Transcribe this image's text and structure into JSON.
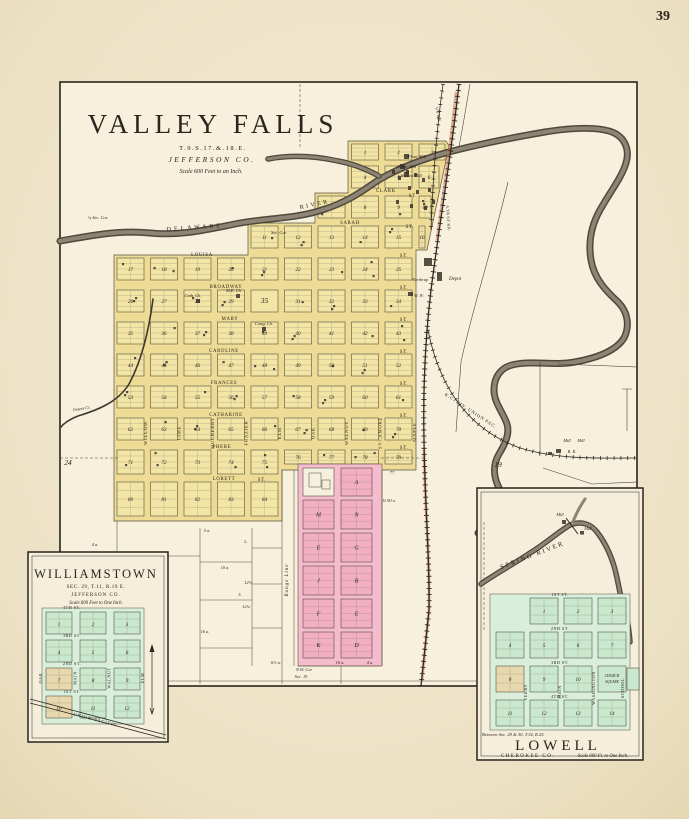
{
  "page": {
    "number": "39"
  },
  "colors": {
    "paper": "#ece1c4",
    "plat_yellow": "#f3e5a6",
    "addition_pink": "#f2aec2",
    "inset_green": "#c9e8cd",
    "railroad_red": "#d4754f",
    "river": "#4f483c",
    "ink": "#2b251c"
  },
  "valley_falls": {
    "title": "VALLEY FALLS",
    "township_line": "T.9.S.17.&.18.E.",
    "county_line": "JEFFERSON CO.",
    "scale_line": "Scale 600 Feet to an Inch.",
    "river_name_1": "DELAWARE",
    "river_name_2": "RIVER",
    "creek_label": "Peters Cr.",
    "streets_horizontal": [
      "CLARK",
      "SARAH",
      "LOUISA",
      "BROADWAY",
      "MARY",
      "CAROLINE",
      "FRANCES",
      "CATHARINE",
      "PHEBE",
      "LORETT"
    ],
    "street_suffix": "ST.",
    "streets_vertical": [
      "WILLOW",
      "LIME",
      "MULBERRY",
      "FRAZIER",
      "ELM",
      "OAK",
      "WALNUT",
      "SYCAMORE",
      "MAPLE"
    ],
    "railroads": {
      "kc_div": "K.C. DIV. UNION PAC.",
      "up_branch": "U.P. R.R.",
      "atsf": "A.T.& S.F. R.R.",
      "rr": "R. R."
    },
    "mills": [
      "Flour Mill",
      "Flour Mill",
      "Woolen Mill"
    ],
    "mill_right": "Mill",
    "depot_label": "Depot",
    "northrup_label": "Northrup",
    "water_works": "W. W.",
    "churches": [
      "Cath. Ch.",
      "M.E. Ch.",
      "Cong. Ch."
    ],
    "sec_24": "24",
    "sec_19": "19",
    "quarter_sec_cor": "¼ Sec. Cor.",
    "sec_cor": "Sec. Cor.",
    "nw_cor": "N.W. Cor",
    "nw_cor_sec": "Sec. 19",
    "range_line": "Range Line",
    "plaza_number": "35",
    "acreage_labels": [
      "5 a.",
      "4 a.",
      "L.",
      "10 a.",
      "12½",
      "5.",
      "12¼",
      "16 a.",
      "6½ a.",
      "10 a.",
      "4 a.",
      "77",
      "11.90 a."
    ],
    "pink_letters": [
      "A",
      "M",
      "N",
      "E",
      "G",
      "J",
      "B",
      "F",
      "E",
      "K",
      "D"
    ],
    "block_numbers": [
      "1",
      "2",
      "3",
      "4",
      "5",
      "6",
      "7",
      "8",
      "9",
      "10",
      "11",
      "12",
      "13",
      "14",
      "15",
      "16",
      "17",
      "18",
      "19",
      "20",
      "21",
      "22",
      "23",
      "24",
      "25",
      "26",
      "27",
      "28",
      "29",
      "35",
      "31",
      "32",
      "33",
      "34",
      "35",
      "36",
      "37",
      "38",
      "39",
      "40",
      "41",
      "42",
      "43",
      "44",
      "45",
      "46",
      "47",
      "48",
      "49",
      "50",
      "51",
      "52",
      "53",
      "54",
      "55",
      "56",
      "57",
      "58",
      "59",
      "60",
      "61",
      "62",
      "63",
      "64",
      "65",
      "66",
      "67",
      "68",
      "69",
      "70",
      "71",
      "72",
      "73",
      "74",
      "75",
      "76",
      "77",
      "78",
      "79",
      "80",
      "81",
      "82",
      "83",
      "84"
    ]
  },
  "williamstown": {
    "title": "WILLIAMSTOWN",
    "section_line": "SEC. 29, T.11, R.19 E.",
    "county_line": "JEFFERSON CO.",
    "scale_line": "Scale 600 Feet to One Inch.",
    "railroad_label": "UNION PACIFIC",
    "streets_horizontal": [
      "4TH ST.",
      "3RD ST.",
      "2ND ST.",
      "1ST ST."
    ],
    "streets_vertical": [
      "OAK",
      "MAIN",
      "WALNUT",
      "ELM"
    ],
    "block_numbers": [
      "1",
      "2",
      "3",
      "4",
      "5",
      "6",
      "7",
      "8",
      "9",
      "10",
      "11",
      "12"
    ]
  },
  "lowell": {
    "title": "LOWELL",
    "county_line": "CHEROKEE CO.",
    "scale_line": "Scale 600 Ft. to One Inch.",
    "note_line": "Between Sec. 29 & 30, T.34, R.25.",
    "river_label": "SPRING RIVER",
    "mill_label": "Mill",
    "streets_horizontal": [
      "1ST ST.",
      "2ND ST.",
      "3RD ST.",
      "4TH ST."
    ],
    "streets_vertical": [
      "FERRY",
      "MAIN",
      "WASHINGTON",
      "SCHOOL"
    ],
    "church_square": [
      "CHURCH",
      "SQUARE"
    ],
    "block_numbers": [
      "1",
      "2",
      "3",
      "4",
      "5",
      "6",
      "7",
      "8",
      "9",
      "10",
      "11",
      "12",
      "13",
      "14"
    ]
  }
}
